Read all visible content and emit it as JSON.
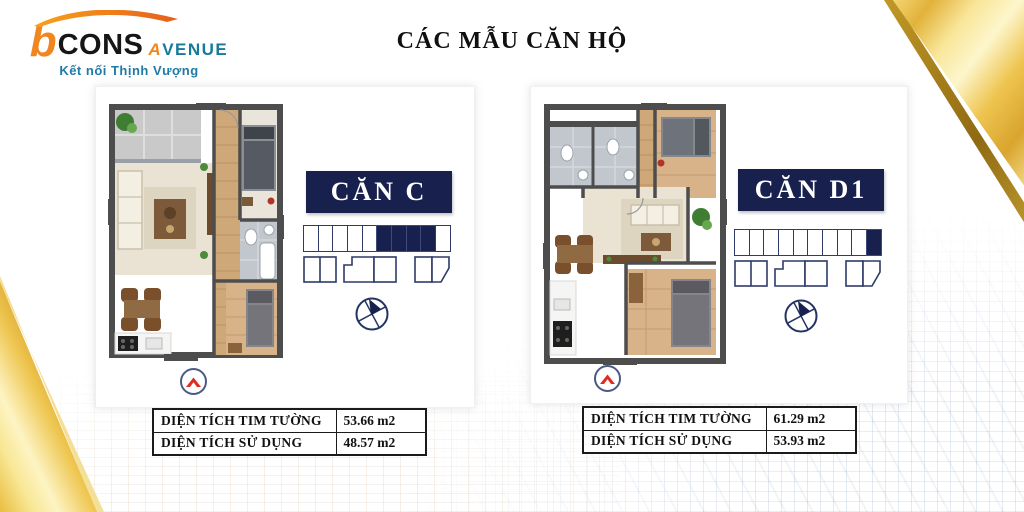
{
  "logo": {
    "b": "b",
    "cons": "CONS",
    "avenue_a": "A",
    "avenue_rest": "VENUE",
    "tagline": "Kết nối Thịnh Vượng"
  },
  "title": "CÁC MẪU CĂN HỘ",
  "units": [
    {
      "name": "CĂN C",
      "position_strip": {
        "total_cells": 10,
        "filled_cells": [
          5,
          6,
          7,
          8
        ]
      },
      "area_table": {
        "rows": [
          {
            "label": "DIỆN TÍCH TIM TƯỜNG",
            "value": "53.66 m2"
          },
          {
            "label": "DIỆN TÍCH SỬ DỤNG",
            "value": "48.57 m2"
          }
        ]
      }
    },
    {
      "name": "CĂN D1",
      "position_strip": {
        "total_cells": 10,
        "filled_cells": [
          9
        ]
      },
      "area_table": {
        "rows": [
          {
            "label": "DIỆN TÍCH TIM TƯỜNG",
            "value": "61.29 m2"
          },
          {
            "label": "DIỆN TÍCH SỬ DỤNG",
            "value": "53.93 m2"
          }
        ]
      }
    }
  ],
  "icons": {
    "compass": "compass-north-arrow-icon",
    "up_arrow": "red-chevron-up-icon",
    "logo_swoosh": "orange-swoosh-icon"
  },
  "colors": {
    "navy": "#18214d",
    "gold": "#e9c254",
    "red": "#e02b20",
    "teal": "#177a9b",
    "orange": "#f0861f"
  }
}
